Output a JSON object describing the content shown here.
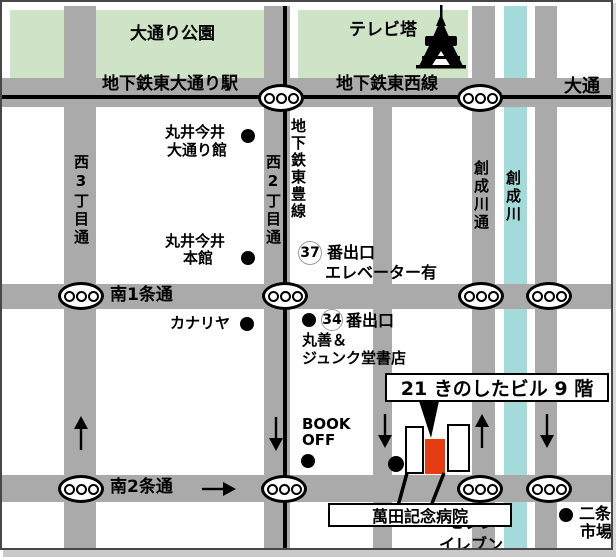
{
  "colors": {
    "road": "#aaaaaa",
    "park": "#cfe3c7",
    "river": "#a2dbd9",
    "highlight_red": "#e73c12",
    "line": "#000000"
  },
  "parks": {
    "odori_park": "大通り公園",
    "tv_tower": "テレビ塔"
  },
  "roads": {
    "odori_station": "地下鉄東大通り駅",
    "tozai_line": "地下鉄東西線",
    "odori_ave": "大通",
    "minami1": "南1条通",
    "minami2": "南2条通",
    "nishi3": "西3丁目通",
    "nishi2": "西2丁目通",
    "toho_line": "地下鉄東豊線",
    "soseigawa_dori": "創成川通",
    "sosei_river": "創成川"
  },
  "landmarks": {
    "marui_odorikan": {
      "line1": "丸井今井",
      "line2": "大通り館"
    },
    "marui_honkan": {
      "line1": "丸井今井",
      "line2": "本館"
    },
    "exit37": {
      "number": "37",
      "label": "番出口",
      "note": "エレベーター有"
    },
    "exit34": {
      "number": "34",
      "label": "番出口"
    },
    "kanariya": "カナリヤ",
    "maruzen_junkudo": {
      "line1": "丸善＆",
      "line2": "ジュンク堂書店"
    },
    "book_off": {
      "line1": "BOOK",
      "line2": "OFF"
    },
    "manda_hospital": "萬田記念病院",
    "seven_eleven": {
      "line1": "セブン",
      "line2": "イレブン"
    },
    "nijo_market": {
      "line1": "二条",
      "line2": "市場"
    }
  },
  "destination": {
    "label": "21 きのしたビル 9 階"
  }
}
